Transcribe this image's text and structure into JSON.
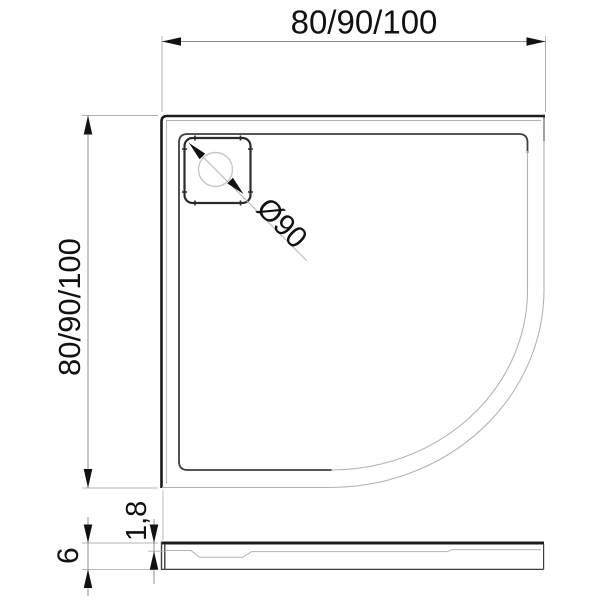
{
  "drawing": {
    "subject": "quadrant-shower-tray-technical-drawing",
    "views": {
      "plan": "top-view-with-drain",
      "profile": "side-section-view"
    },
    "dimensions": {
      "width_label": "80/90/100",
      "depth_label": "80/90/100",
      "drain_label": "Ø90",
      "total_height_label": "6",
      "rim_thickness_label": "1,8"
    },
    "colors": {
      "outline": "#1c1c1c",
      "inner_rim_line": "#3f3f3f",
      "thin_line": "#b3b3b3",
      "dimension_line": "#8f8f8f",
      "arrow_and_text": "#111111",
      "background": "#ffffff"
    }
  }
}
